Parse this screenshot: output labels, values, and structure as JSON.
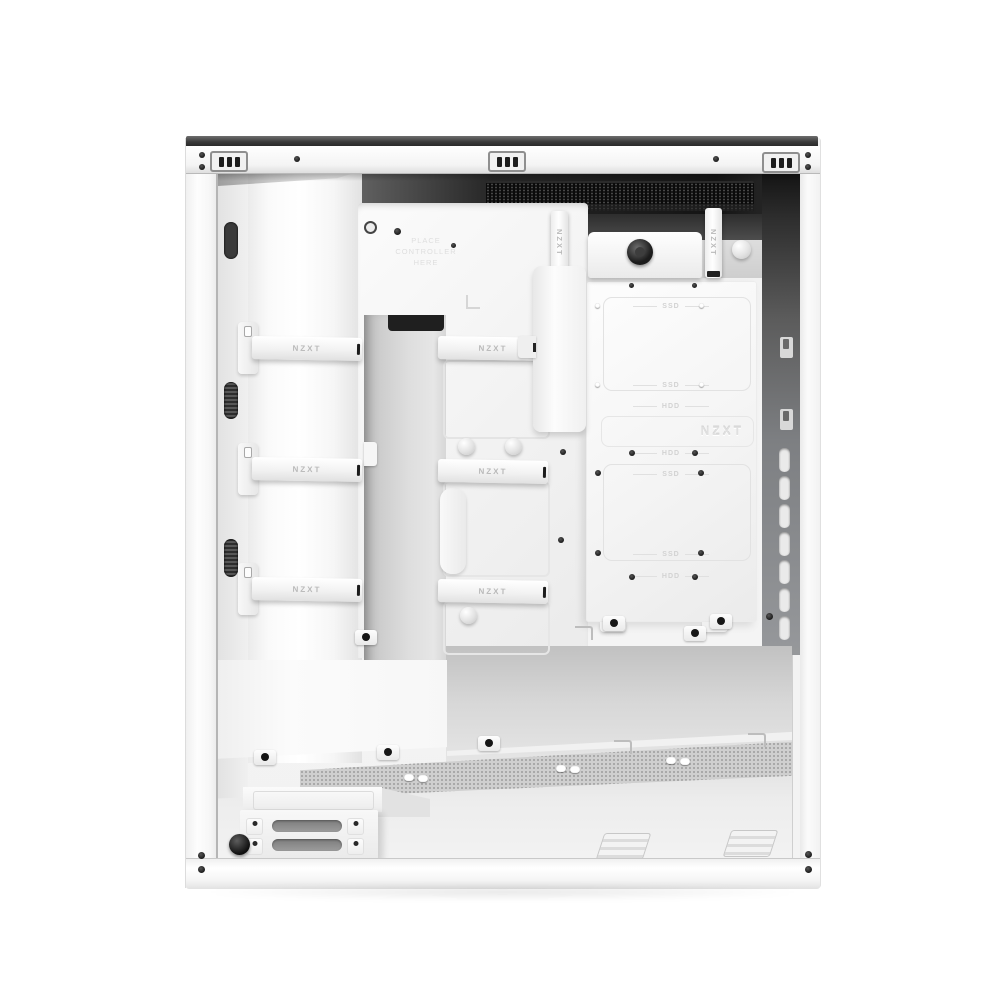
{
  "scene": {
    "description": "Interior cable-management side of a white NZXT mid-tower PC case with the side panel removed, product photo on a white studio background"
  },
  "branding": {
    "strap_label": "NZXT",
    "embossed_logo": "NZXT"
  },
  "labels": {
    "controller_note": "PLACE CONTROLLER HERE",
    "ssd": "SSD",
    "hdd": "HDD"
  },
  "colors": {
    "background": "#ffffff",
    "case_white": "#f7f7f7",
    "top_cap_dark": "#3a3a3a",
    "vent_black": "#0d0d0d",
    "rear_panel_gray": "#7d7f82",
    "mesh_gray": "#cfcfcf",
    "strap_text_gray": "#b9b9b9",
    "emboss_gray": "#dcdcdc"
  }
}
